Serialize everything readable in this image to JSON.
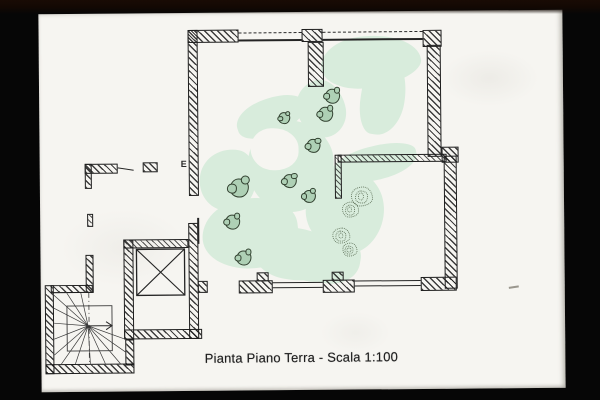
{
  "photo": {
    "background_color": "#060606",
    "top_tint": "#190b04"
  },
  "sheet": {
    "paper_color": "#f6f5f1",
    "edge_shadow": "#6e695f"
  },
  "caption": {
    "text": "Pianta Piano Terra - Scala 1:100"
  },
  "plan": {
    "door_label": "E",
    "ink_color": "#1d1d1d",
    "highlight_green": "#d8ecdc",
    "bush_outline_color": "#31402f",
    "bush_fill_color": "#aed0b5",
    "scribble_color": "#5c6f57"
  },
  "vegetation": {
    "bushes": [
      [
        293,
        84,
        15
      ],
      [
        286,
        102,
        15
      ],
      [
        245,
        106,
        12
      ],
      [
        274,
        134,
        14
      ],
      [
        199,
        175,
        19
      ],
      [
        250,
        169,
        14
      ],
      [
        269,
        184,
        13
      ],
      [
        192,
        209,
        15
      ],
      [
        203,
        245,
        15
      ]
    ],
    "scribbles": [
      [
        322,
        185,
        22
      ],
      [
        310,
        198,
        17
      ],
      [
        301,
        224,
        18
      ],
      [
        309,
        238,
        15
      ]
    ]
  }
}
